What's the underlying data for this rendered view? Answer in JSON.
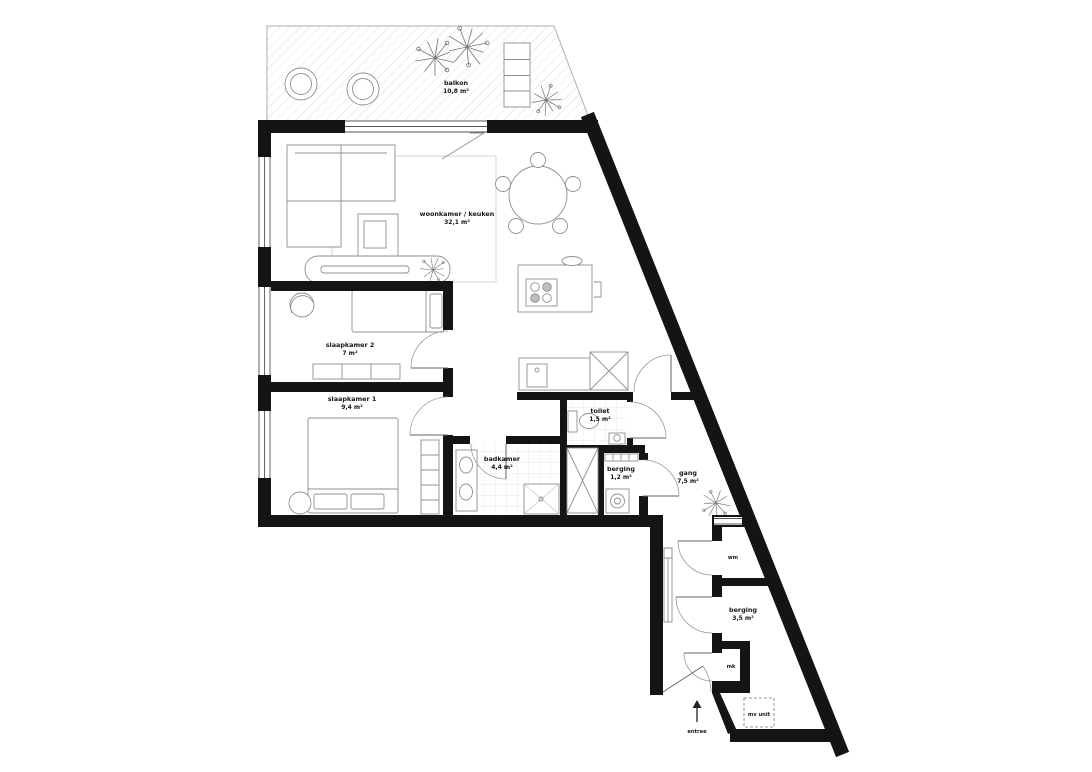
{
  "plan": {
    "rooms": [
      {
        "id": "balkon",
        "name": "balkon",
        "area": "10,8 m²"
      },
      {
        "id": "woonkamer-keuken",
        "name": "woonkamer / keuken",
        "area": "32,1 m²"
      },
      {
        "id": "slaapkamer-2",
        "name": "slaapkamer 2",
        "area": "7 m²"
      },
      {
        "id": "slaapkamer-1",
        "name": "slaapkamer 1",
        "area": "9,4 m²"
      },
      {
        "id": "badkamer",
        "name": "badkamer",
        "area": "4,4 m²"
      },
      {
        "id": "toilet",
        "name": "toilet",
        "area": "1,5 m²"
      },
      {
        "id": "berging-klein",
        "name": "berging",
        "area": "1,2 m²"
      },
      {
        "id": "gang",
        "name": "gang",
        "area": "7,5 m²"
      },
      {
        "id": "berging-groot",
        "name": "berging",
        "area": "3,5 m²"
      }
    ],
    "small_labels": {
      "washing_machine": "wm",
      "meter_cupboard": "mk",
      "mv_unit": "mv unit"
    },
    "entrance_label": "entree",
    "colors": {
      "wall": "#141414",
      "furniture_line": "#8f8f8f",
      "tile_line": "#e3e3e3",
      "hatch_line": "#dcdcdc",
      "label": "#161616",
      "background": "#ffffff"
    }
  }
}
